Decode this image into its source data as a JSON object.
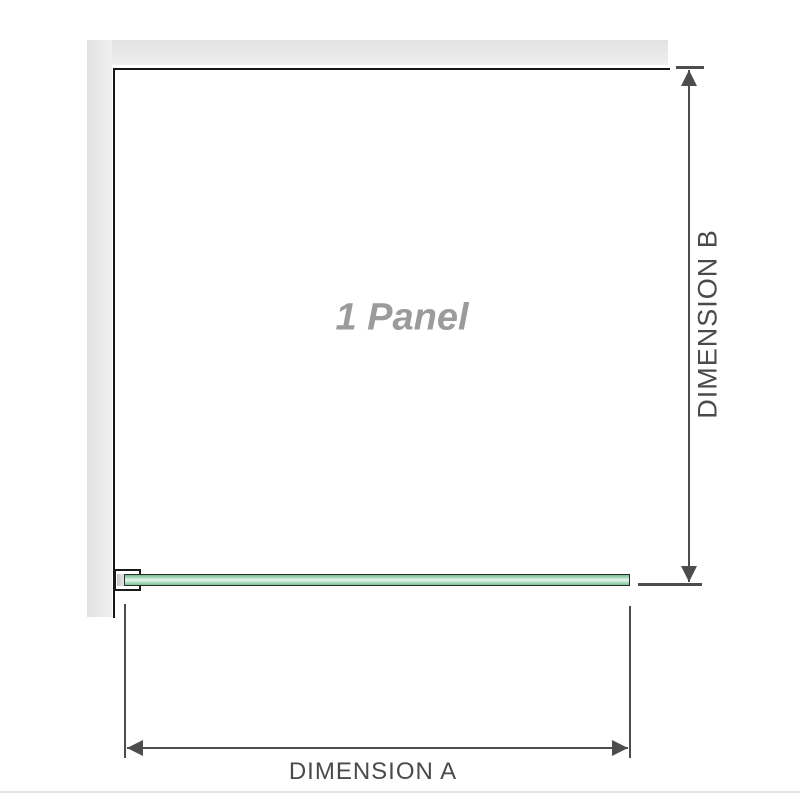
{
  "diagram": {
    "panel_label": "1 Panel",
    "dimension_a_label": "DIMENSION A",
    "dimension_b_label": "DIMENSION B",
    "colors": {
      "wall_grey": "#e7e7e7",
      "panel_outline": "#161616",
      "dimension_line": "#4d4d4d",
      "dimension_text": "#4a4a4a",
      "glass_green": "#9fd2b2",
      "glass_highlight": "#eef8f1",
      "panel_label_grey": "#9b9b9b",
      "bottom_rule": "#e6e5df"
    }
  }
}
